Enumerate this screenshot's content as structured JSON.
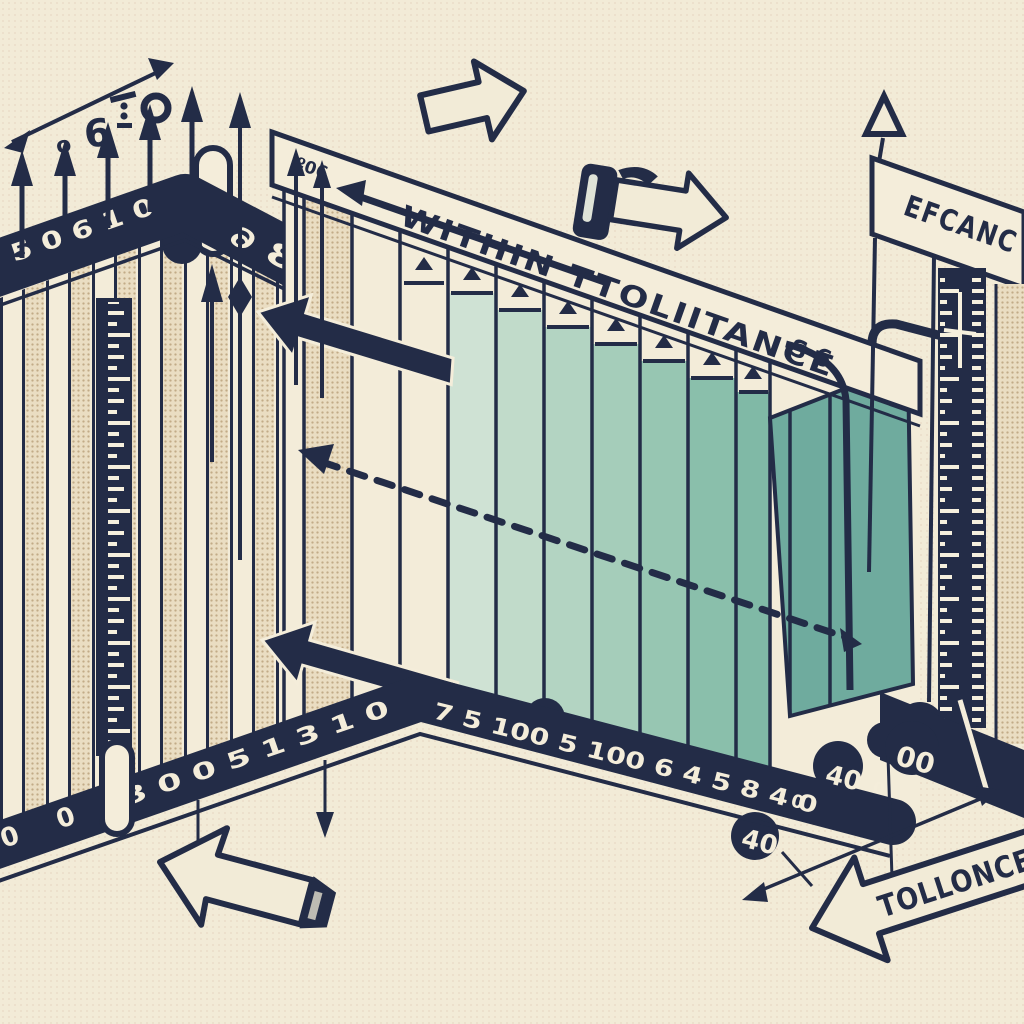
{
  "colors": {
    "navy": "#232c47",
    "cream": "#f4edda",
    "background": "#f2ebd7",
    "teal_dark": "#6fab9e",
    "teal_light": "#cfe2d4",
    "tan_dots": "#c9b392"
  },
  "left_panel": {
    "top_numbers_left": "5 0 6 1 0",
    "top_numbers_right": "∂ 8",
    "glyph_small_o": "o",
    "glyph_six": "6",
    "bottom_numbers": "3 0 0 5 1 3 1 0",
    "bottom_zeros": "0 0"
  },
  "middle_panel": {
    "band_prefix": "º06",
    "band_label": "WITHIN TTOLIITANCE",
    "band_suffix": "S 6",
    "bottom_numbers": "7 5 100 5 100 6 4 5 8 4 0",
    "bump_40_low": "40",
    "inline_zero_1": "0",
    "bump_40_high": "40",
    "inline_zero_2": "0",
    "bump_00": "00"
  },
  "right_panel": {
    "band_label": "EFCANC"
  },
  "bottom_arrow": {
    "label": "TOLLONCE"
  }
}
